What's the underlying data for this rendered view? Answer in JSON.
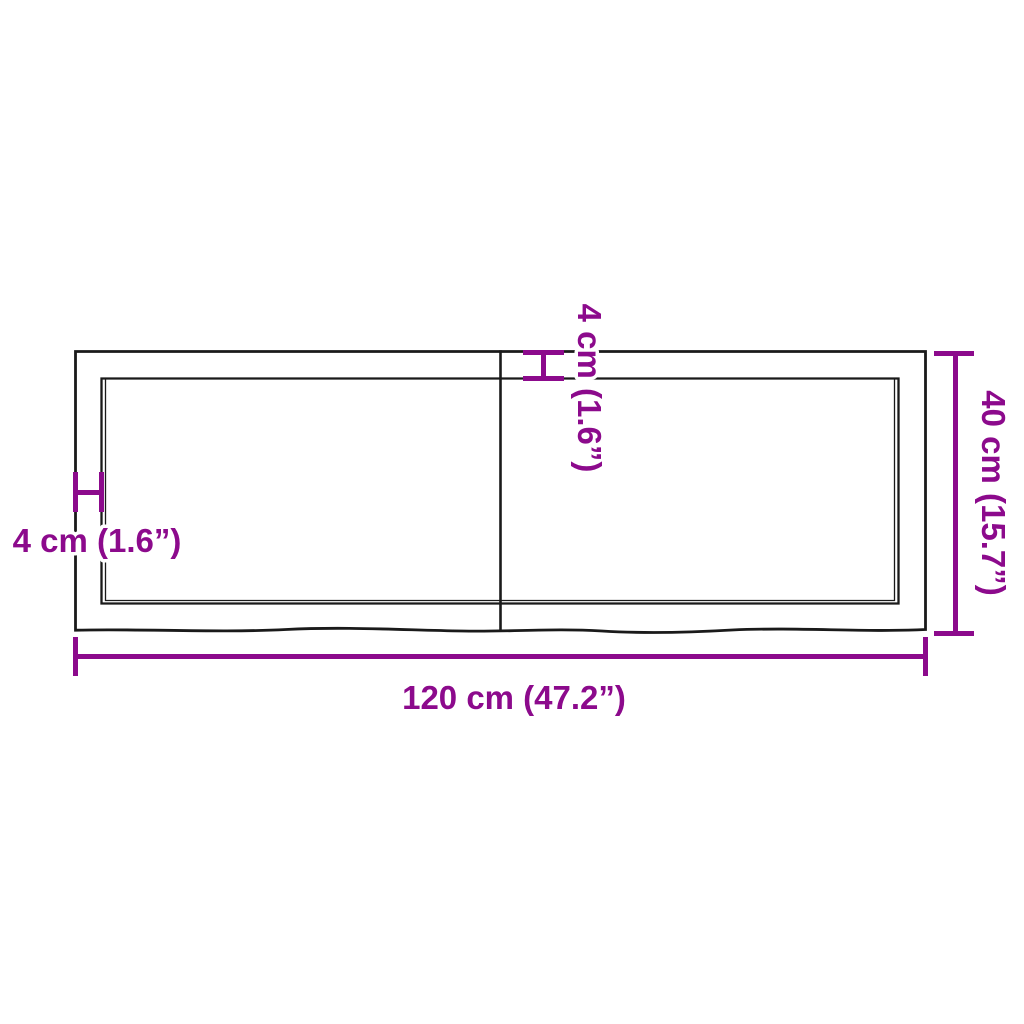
{
  "diagram": {
    "kind": "product-dimension-diagram",
    "subject": "wooden table top / shelf panel, top view with live (wavy) front edge and centre joint",
    "background": "#ffffff"
  },
  "colors": {
    "dimension_accent": "#8c0a8c",
    "outline": "#1a1a1a"
  },
  "labels": {
    "width": "120 cm (47.2”)",
    "height": "40 cm (15.7”)",
    "edge_left": "4 cm (1.6”)",
    "edge_top": "4 cm (1.6”)"
  },
  "measurements": {
    "width_cm": 120,
    "width_inch": 47.2,
    "height_cm": 40,
    "height_inch": 15.7,
    "edge_offset_cm": 4,
    "edge_offset_inch": 1.6
  }
}
